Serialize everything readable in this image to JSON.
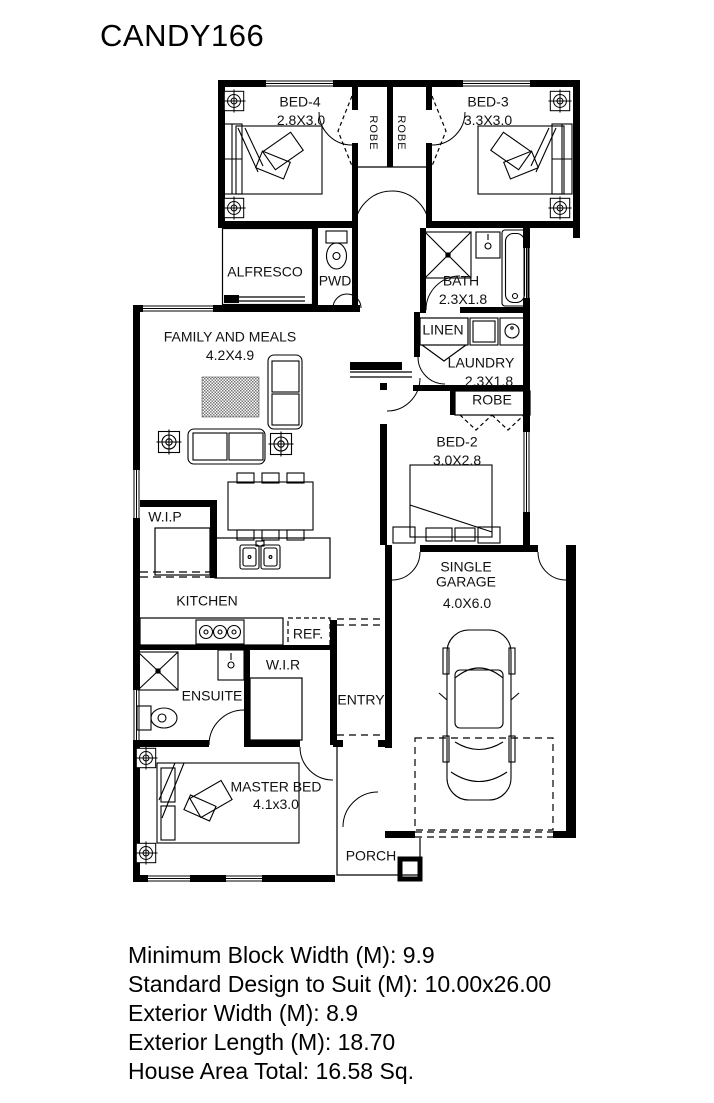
{
  "title": "CANDY166",
  "rooms": {
    "bed4": {
      "name": "BED-4",
      "dims": "2.8X3.0"
    },
    "bed3": {
      "name": "BED-3",
      "dims": "3.3X3.0"
    },
    "robe_bed4": {
      "name": "ROBE"
    },
    "robe_bed3": {
      "name": "ROBE"
    },
    "alfresco": {
      "name": "ALFRESCO"
    },
    "pwd": {
      "name": "PWD."
    },
    "bath": {
      "name": "BATH",
      "dims": "2.3X1.8"
    },
    "family": {
      "name": "FAMILY AND MEALS",
      "dims": "4.2X4.9"
    },
    "linen": {
      "name": "LINEN"
    },
    "laundry": {
      "name": "LAUNDRY",
      "dims": "2.3X1.8"
    },
    "robe_bed2": {
      "name": "ROBE"
    },
    "bed2": {
      "name": "BED-2",
      "dims": "3.0X2.8"
    },
    "wip": {
      "name": "W.I.P"
    },
    "kitchen": {
      "name": "KITCHEN"
    },
    "ref": {
      "name": "REF."
    },
    "ensuite": {
      "name": "ENSUITE"
    },
    "wir": {
      "name": "W.I.R"
    },
    "entry": {
      "name": "ENTRY"
    },
    "garage": {
      "name": "SINGLE GARAGE",
      "dims": "4.0X6.0"
    },
    "master": {
      "name": "MASTER BED",
      "dims": "4.1x3.0"
    },
    "porch": {
      "name": "PORCH"
    }
  },
  "specs": {
    "minimum_block_width": "Minimum Block Width (M): 9.9",
    "standard_design_to_suit": "Standard Design to Suit (M): 10.00x26.00",
    "exterior_width": "Exterior Width (M): 8.9",
    "exterior_length": "Exterior Length (M): 18.70",
    "house_area_total": "House Area Total: 16.58 Sq."
  },
  "colors": {
    "line": "#000000",
    "background": "#ffffff",
    "text": "#000000"
  }
}
